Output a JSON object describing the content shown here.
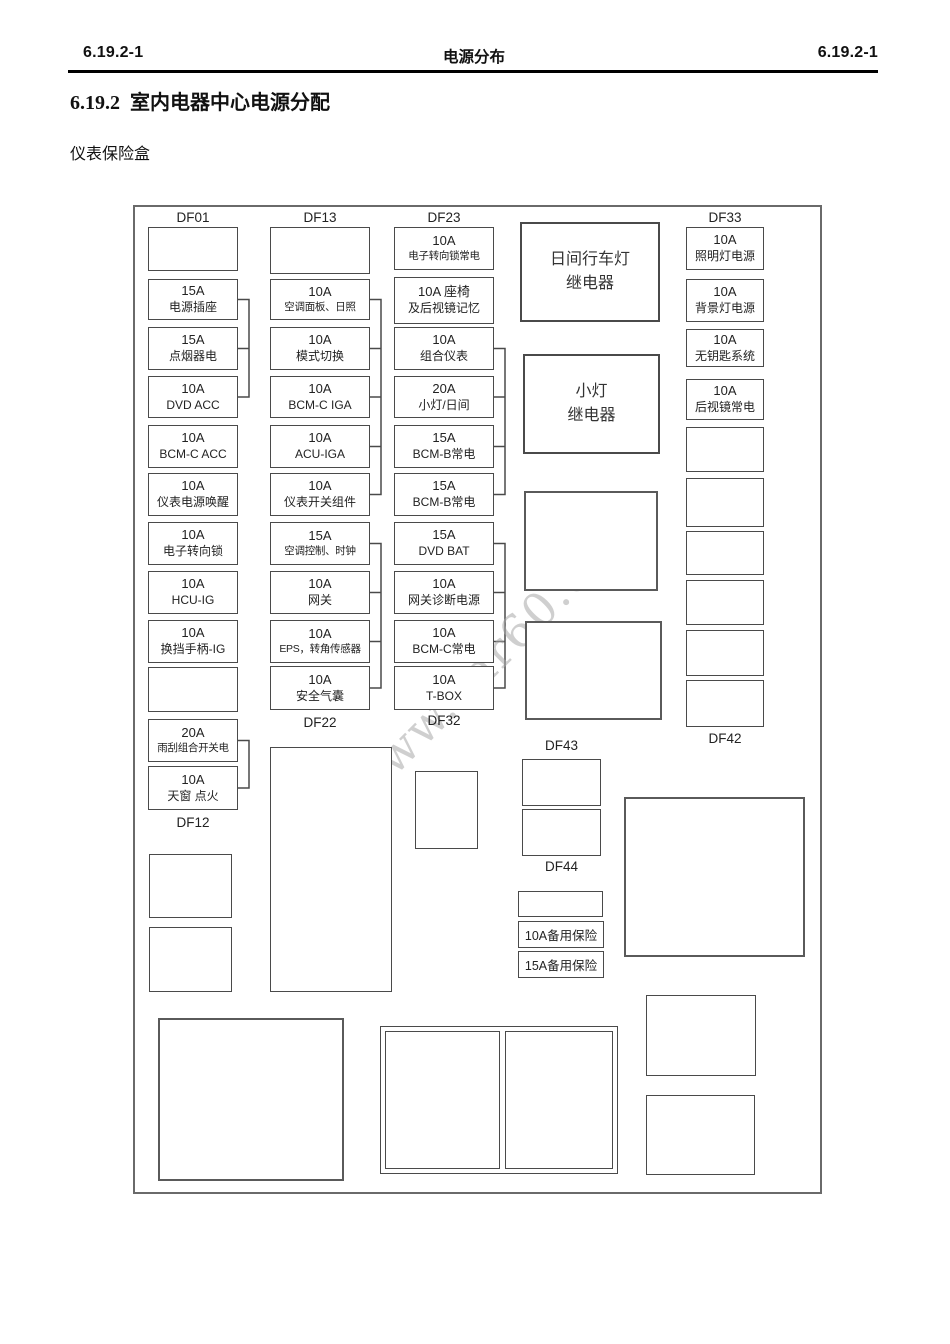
{
  "page": {
    "header": {
      "left": "6.19.2-1",
      "center": "电源分布",
      "right": "6.19.2-1"
    },
    "title_number": "6.19.2",
    "title_text": "室内电器中心电源分配",
    "subtitle": "仪表保险盒",
    "watermark": "www.car60.com"
  },
  "diagram": {
    "col1": {
      "top_label": "DF01",
      "bottom_label": "DF12",
      "fuses": [
        {
          "amp": "",
          "name": ""
        },
        {
          "amp": "15A",
          "name": "电源插座"
        },
        {
          "amp": "15A",
          "name": "点烟器电"
        },
        {
          "amp": "10A",
          "name": "DVD ACC"
        },
        {
          "amp": "10A",
          "name": "BCM-C ACC"
        },
        {
          "amp": "10A",
          "name": "仪表电源唤醒"
        },
        {
          "amp": "10A",
          "name": "电子转向锁"
        },
        {
          "amp": "10A",
          "name": "HCU-IG"
        },
        {
          "amp": "10A",
          "name": "换挡手柄-IG"
        },
        {
          "amp": "",
          "name": ""
        },
        {
          "amp": "20A",
          "name": "雨刮组合开关电"
        },
        {
          "amp": "10A",
          "name": "天窗 点火"
        }
      ]
    },
    "col2": {
      "top_label": "DF13",
      "bottom_label": "DF22",
      "fuses": [
        {
          "amp": "",
          "name": ""
        },
        {
          "amp": "10A",
          "name": "空调面板、日照"
        },
        {
          "amp": "10A",
          "name": "模式切换"
        },
        {
          "amp": "10A",
          "name": "BCM-C IGA"
        },
        {
          "amp": "10A",
          "name": "ACU-IGA"
        },
        {
          "amp": "10A",
          "name": "仪表开关组件"
        },
        {
          "amp": "15A",
          "name": "空调控制、时钟"
        },
        {
          "amp": "10A",
          "name": "网关"
        },
        {
          "amp": "10A",
          "name": "EPS，转角传感器"
        },
        {
          "amp": "10A",
          "name": "安全气囊"
        }
      ]
    },
    "col3": {
      "top_label": "DF23",
      "bottom_label": "DF32",
      "fuses": [
        {
          "amp": "10A",
          "name": "电子转向锁常电"
        },
        {
          "amp": "10A 座椅",
          "name": "及后视镜记忆"
        },
        {
          "amp": "10A",
          "name": "组合仪表"
        },
        {
          "amp": "20A",
          "name": "小灯/日间"
        },
        {
          "amp": "15A",
          "name": "BCM-B常电"
        },
        {
          "amp": "15A",
          "name": "BCM-B常电"
        },
        {
          "amp": "15A",
          "name": "DVD BAT"
        },
        {
          "amp": "10A",
          "name": "网关诊断电源"
        },
        {
          "amp": "10A",
          "name": "BCM-C常电"
        },
        {
          "amp": "10A",
          "name": "T-BOX"
        }
      ]
    },
    "col4": {
      "top_label": "DF33",
      "bottom_label": "DF42",
      "fuses": [
        {
          "amp": "10A",
          "name": "照明灯电源"
        },
        {
          "amp": "10A",
          "name": "背景灯电源"
        },
        {
          "amp": "10A",
          "name": "无钥匙系统"
        },
        {
          "amp": "10A",
          "name": "后视镜常电"
        }
      ]
    },
    "relays": {
      "daytime_running_lamp": {
        "line1": "日间行车灯",
        "line2": "继电器"
      },
      "small_lamp": {
        "line1": "小灯",
        "line2": "继电器"
      }
    },
    "mid_labels": {
      "df43": "DF43",
      "df44": "DF44"
    },
    "spare_fuses": {
      "s10": "10A备用保险",
      "s15": "15A备用保险"
    }
  }
}
